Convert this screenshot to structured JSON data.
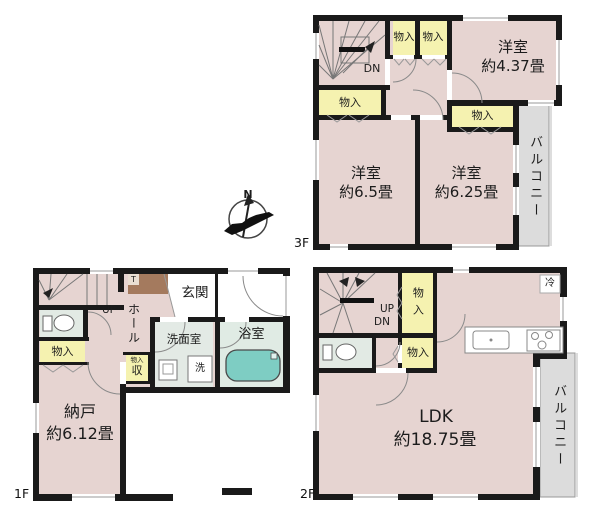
{
  "compass": {
    "north": "N"
  },
  "colors": {
    "wall": "#1a1a1a",
    "room_pink": "#e6d4d1",
    "closet_yellow": "#f5f2b0",
    "balcony_gray": "#dcdcdc",
    "wet_area_green": "#e2eae4",
    "bathtub_teal": "#7ecdc3",
    "cabinet_brown": "#a47a5e"
  },
  "floors": {
    "f3": {
      "floor_label": "3F",
      "stairs_dn": "DN",
      "closet_top_left": "物入",
      "closet_top_right": "物入",
      "closet_left": "物入",
      "closet_inner": "物入",
      "bedroom_small_name": "洋室",
      "bedroom_small_size": "約4.37畳",
      "bedroom_left_name": "洋室",
      "bedroom_left_size": "約6.5畳",
      "bedroom_right_name": "洋室",
      "bedroom_right_size": "約6.25畳",
      "balcony": "バルコニー"
    },
    "f2": {
      "floor_label": "2F",
      "stairs_up": "UP",
      "stairs_dn": "DN",
      "closet_upper": "物入",
      "closet_lower": "物入",
      "fridge": "冷",
      "ldk_name": "LDK",
      "ldk_size": "約18.75畳",
      "balcony": "バルコニー"
    },
    "f1": {
      "floor_label": "1F",
      "stairs_up": "UP",
      "entrance": "玄関",
      "hall": "ホール",
      "shoe_cabinet": "T",
      "closet": "物入",
      "washroom": "洗面室",
      "bathroom": "浴室",
      "washer": "洗",
      "storage_tag": "物入",
      "storage": "収",
      "storeroom_name": "納戸",
      "storeroom_size": "約6.12畳"
    }
  }
}
